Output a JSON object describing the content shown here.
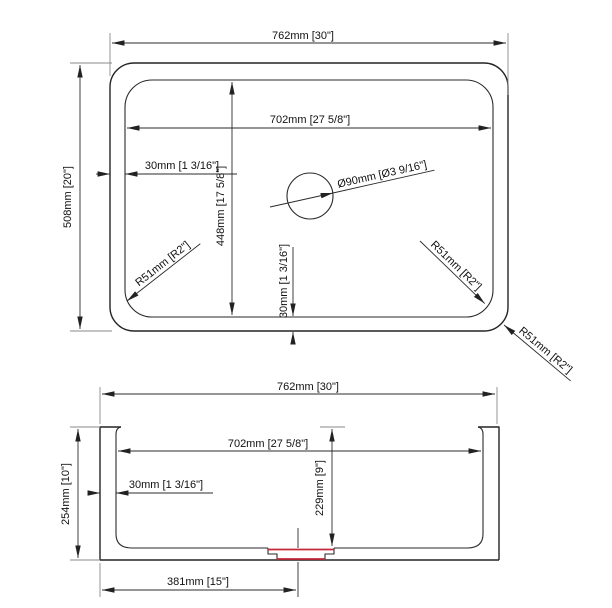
{
  "drawing": {
    "accent_color": "#c5293a",
    "line_color": "#242424",
    "top_view": {
      "overall_width": "762mm [30\"]",
      "overall_depth": "508mm [20\"]",
      "bowl_width": "702mm [27 5/8\"]",
      "bowl_depth": "448mm [17 5/8\"]",
      "rim_offset_left": "30mm [1 3/16\"]",
      "rim_offset_bottom": "30mm [1 3/16\"]",
      "drain_diameter": "Ø90mm [Ø3 9/16\"]",
      "corner_radius_bottom_left": "R51mm [R2\"]",
      "corner_radius_bottom_right": "R51mm [R2\"]",
      "corner_radius_outer": "R51mm [R2\"]"
    },
    "front_view": {
      "overall_width": "762mm [30\"]",
      "bowl_width": "702mm [27 5/8\"]",
      "overall_height": "254mm [10\"]",
      "bowl_depth": "229mm [9\"]",
      "wall_thickness": "30mm [1 3/16\"]",
      "drain_center_offset": "381mm [15\"]"
    }
  }
}
